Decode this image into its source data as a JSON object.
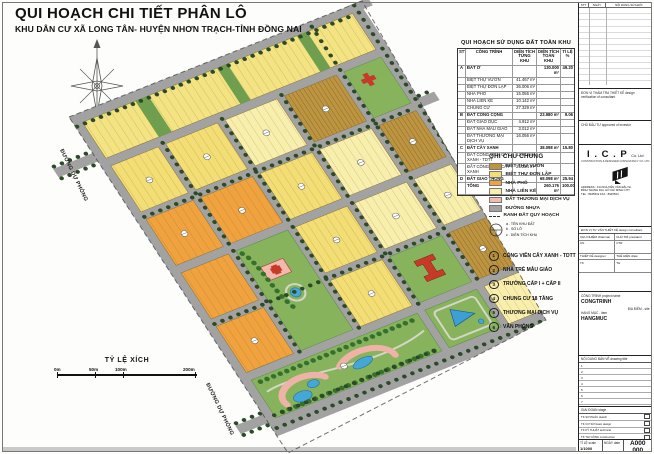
{
  "header": {
    "title": "QUI HOẠCH CHI TIẾT PHÂN LÔ",
    "subtitle": "KHU DÂN CƯ XÃ LONG TÂN- HUYỆN NHƠN TRẠCH-TỈNH ĐỒNG NAI"
  },
  "map": {
    "road_label_left": "ĐƯỜNG DỰ PHÓNG",
    "road_label_bottom": "ĐƯỜNG DỰ PHÓNG"
  },
  "scale_bar": {
    "title": "TỶ LỆ XÍCH",
    "ticks": [
      "0m",
      "50m",
      "100m",
      "200m"
    ]
  },
  "land_use_table": {
    "title": "QUI HOẠCH SỬ DỤNG ĐẤT TOÀN KHU",
    "header": [
      "STT",
      "CÔNG TRÌNH",
      "DIỆN TÍCH TỪNG KHU",
      "DIỆN TÍCH TOÀN KHU",
      "TỈ LỆ %"
    ],
    "rows": [
      [
        "A",
        "ĐẤT Ở",
        "",
        "130.000 m²",
        "49.20",
        "1"
      ],
      [
        "",
        "BIỆT THỰ VƯỜN",
        "41.467 m²",
        "",
        ""
      ],
      [
        "",
        "BIỆT THỰ ĐƠN LẬP",
        "36.006 m²",
        "",
        ""
      ],
      [
        "",
        "NHÀ PHỐ",
        "15.056 m²",
        "",
        ""
      ],
      [
        "",
        "NHÀ LIÊN KẾ",
        "10.142 m²",
        "",
        ""
      ],
      [
        "",
        "CHUNG CƯ",
        "27.329 m²",
        "",
        ""
      ],
      [
        "B",
        "ĐẤT CÔNG CỘNG",
        "",
        "23.980 m²",
        "9.06",
        "1"
      ],
      [
        "",
        "ĐẤT GIÁO DỤC",
        "4.912 m²",
        "",
        ""
      ],
      [
        "",
        "ĐẤT NHÀ MẪU GIÁO",
        "3.012 m²",
        "",
        ""
      ],
      [
        "",
        "ĐẤT THƯƠNG MẠI DỊCH VỤ",
        "16.056 m²",
        "",
        ""
      ],
      [
        "C",
        "ĐẤT CÂY XANH",
        "",
        "38.098 m²",
        "15.80",
        "1"
      ],
      [
        "",
        "ĐẤT CÔNG VIÊN CÂY XANH - TDTT",
        "12.874 m²",
        "",
        ""
      ],
      [
        "",
        "ĐẤT CÔNG VIÊN CÂY XANH",
        "25.224 m²",
        "",
        ""
      ],
      [
        "D",
        "ĐẤT GIAO THÔNG",
        "",
        "68.098 m²",
        "25.94",
        "1"
      ],
      [
        "",
        "TỔNG",
        "",
        "260.176 m²",
        "100.00",
        "1"
      ]
    ]
  },
  "legend": {
    "title": "GHI CHÚ CHUNG",
    "items": [
      {
        "label": "BIỆT THỰ VƯỜN",
        "chip": "background:#bd9440"
      },
      {
        "label": "BIỆT THỰ ĐƠN LẬP",
        "chip": "background:#f2de74"
      },
      {
        "label": "NHÀ PHỐ",
        "chip": "background:#efa23e"
      },
      {
        "label": "NHÀ LIÊN KẾ",
        "chip": "background:#f8efad"
      },
      {
        "label": "ĐẤT THƯƠNG MẠI DỊCH VỤ",
        "chip": "background:#f0bdb4"
      },
      {
        "label": "ĐƯỜNG NHỰA",
        "chip": "background:#a2a2a2"
      },
      {
        "label": "RANH ĐẤT QUY HOẠCH",
        "chip": "height:0;background:none;border:none;border-top:1.6px dashed #333;margin-top:2px"
      }
    ],
    "symbol_notes": [
      "a . TÊN KHU ĐẤT",
      "b . SỐ LÔ",
      "c . DIỆN TÍCH KHU"
    ]
  },
  "notes": [
    {
      "n": "1",
      "label": "CÔNG VIÊN CÂY XANH - TDTT"
    },
    {
      "n": "2",
      "label": "NHÀ TRẺ MẪU GIÁO"
    },
    {
      "n": "3",
      "label": "TRƯỜNG CẤP I + CẤP II"
    },
    {
      "n": "4",
      "label": "CHUNG CƯ 18 TẦNG"
    },
    {
      "n": "5",
      "label": "THƯƠNG MẠI DỊCH VỤ"
    },
    {
      "n": "6",
      "label": "VĂN PHÒNG"
    }
  ],
  "title_block": {
    "rev_header": [
      "STT",
      "NGÀY",
      "NỘI DUNG SỬA ĐỔI"
    ],
    "verify_label": "ĐƠN VỊ THẨM TRA THIẾT KẾ  design verification of consultant",
    "investor_label": "CHỦ ĐẦU TƯ  approved of investor",
    "company": {
      "name": "I . C . P",
      "co": "Co. Ltd",
      "subtitle": "CONSTRUCTION & DESIGNER CONSULTANCY CO. LTD",
      "address1": "ADDRESS : 144 NGUYỄN VĂN ĐẬU St.",
      "address2": "BÌNH THẠNH Dist. HỒ CHÍ MINH CITY",
      "tel": "TEL : 8945532",
      "fax": "FAX : 8945534"
    },
    "consultant_label": "ĐƠN VỊ TƯ VẤN THIẾT KẾ  design consultant",
    "sig_rows": [
      [
        "CHỦ NHIỆM  chairman",
        "CHỦ TRÌ  president"
      ],
      [
        "CN",
        "CTR"
      ],
      [
        "THIẾT KẾ  designer",
        "THỂ HIỆN  draw"
      ],
      [
        "TK",
        "TH"
      ]
    ],
    "project_label": "CÔNG TRÌNH  project name",
    "project_value": "CONGTRINH",
    "site_label": "ĐỊA ĐIỂM - site",
    "item_label": "HẠNG MỤC - item",
    "item_value": "HANGMUC",
    "drawing_label": "NỘI DUNG BẢN VẼ  drawing title",
    "drawing_rows": [
      "1",
      "2",
      "3",
      "4",
      "5",
      "6",
      "7"
    ],
    "stage_label": "GIAI ĐOẠN  stage",
    "stage_rows": [
      "TK SƠ PHÁC  sketch",
      "TK CƠ SỞ  basic design",
      "TK KỸ THUẬT  technical",
      "TK THI CÔNG  construction",
      "HOÀN CÔNG  as-built"
    ],
    "scale_label": "TỈ LỆ  scale",
    "scale_value": "1/1000",
    "date_label": "NGÀY  date",
    "date_value": "",
    "number_top": "A000",
    "number_bottom": "000"
  }
}
